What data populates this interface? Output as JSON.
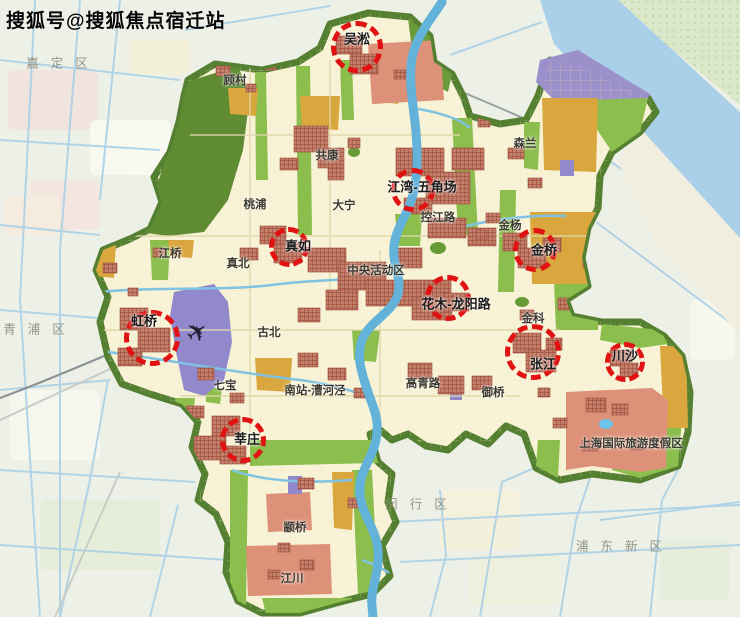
{
  "watermark": "搜狐号@搜狐焦点宿迁站",
  "map": {
    "city_centers": [
      {
        "name": "吴淞",
        "cx": 357,
        "cy": 47,
        "r": 26,
        "lx": 357,
        "ly": 38
      },
      {
        "name": "江湾-五角场",
        "cx": 413,
        "cy": 190,
        "r": 22,
        "lx": 422,
        "ly": 186
      },
      {
        "name": "真如",
        "cx": 289,
        "cy": 247,
        "r": 20,
        "lx": 298,
        "ly": 245
      },
      {
        "name": "金桥",
        "cx": 535,
        "cy": 250,
        "r": 22,
        "lx": 544,
        "ly": 249
      },
      {
        "name": "花木-龙阳路",
        "cx": 448,
        "cy": 298,
        "r": 23,
        "lx": 456,
        "ly": 303
      },
      {
        "name": "虹桥",
        "cx": 152,
        "cy": 338,
        "r": 28,
        "lx": 144,
        "ly": 320
      },
      {
        "name": "张江",
        "cx": 533,
        "cy": 352,
        "r": 28,
        "lx": 543,
        "ly": 363
      },
      {
        "name": "川沙",
        "cx": 625,
        "cy": 362,
        "r": 20,
        "lx": 625,
        "ly": 355
      },
      {
        "name": "莘庄",
        "cx": 243,
        "cy": 440,
        "r": 23,
        "lx": 247,
        "ly": 438
      }
    ],
    "places": [
      {
        "name": "顾村",
        "x": 235,
        "y": 80
      },
      {
        "name": "共康",
        "x": 327,
        "y": 155
      },
      {
        "name": "桃浦",
        "x": 255,
        "y": 204
      },
      {
        "name": "大宁",
        "x": 344,
        "y": 205
      },
      {
        "name": "控江路",
        "x": 438,
        "y": 217
      },
      {
        "name": "金杨",
        "x": 510,
        "y": 225
      },
      {
        "name": "森兰",
        "x": 525,
        "y": 143
      },
      {
        "name": "江桥",
        "x": 170,
        "y": 253
      },
      {
        "name": "真北",
        "x": 238,
        "y": 263
      },
      {
        "name": "中央活动区",
        "x": 376,
        "y": 270
      },
      {
        "name": "古北",
        "x": 269,
        "y": 332
      },
      {
        "name": "金科",
        "x": 533,
        "y": 318
      },
      {
        "name": "七宝",
        "x": 225,
        "y": 385
      },
      {
        "name": "南站-漕河泾",
        "x": 315,
        "y": 390
      },
      {
        "name": "高青路",
        "x": 423,
        "y": 383
      },
      {
        "name": "御桥",
        "x": 493,
        "y": 392
      },
      {
        "name": "上海国际旅游度假区",
        "x": 631,
        "y": 443
      },
      {
        "name": "颛桥",
        "x": 295,
        "y": 527
      },
      {
        "name": "江川",
        "x": 292,
        "y": 578
      }
    ],
    "districts": [
      {
        "name": "嘉定区",
        "x": 63,
        "y": 62
      },
      {
        "name": "青浦区",
        "x": 40,
        "y": 328
      },
      {
        "name": "闵行区",
        "x": 422,
        "y": 503
      },
      {
        "name": "浦东新区",
        "x": 625,
        "y": 545
      }
    ],
    "airport": {
      "icon": "✈",
      "x": 197,
      "y": 332
    },
    "colors": {
      "ring_red": "#e01212",
      "city_fill": "#f8f3d7",
      "boundary_green": "#558031",
      "park_green": "#8cbe4d",
      "urban_block_red": "#b2604e",
      "industry_orange": "#d9a73e",
      "residential_salmon": "#de9179",
      "airport_purple": "#9189cc",
      "river_blue": "#64b2d9",
      "yangtze_blue": "#a9cfe9"
    }
  }
}
